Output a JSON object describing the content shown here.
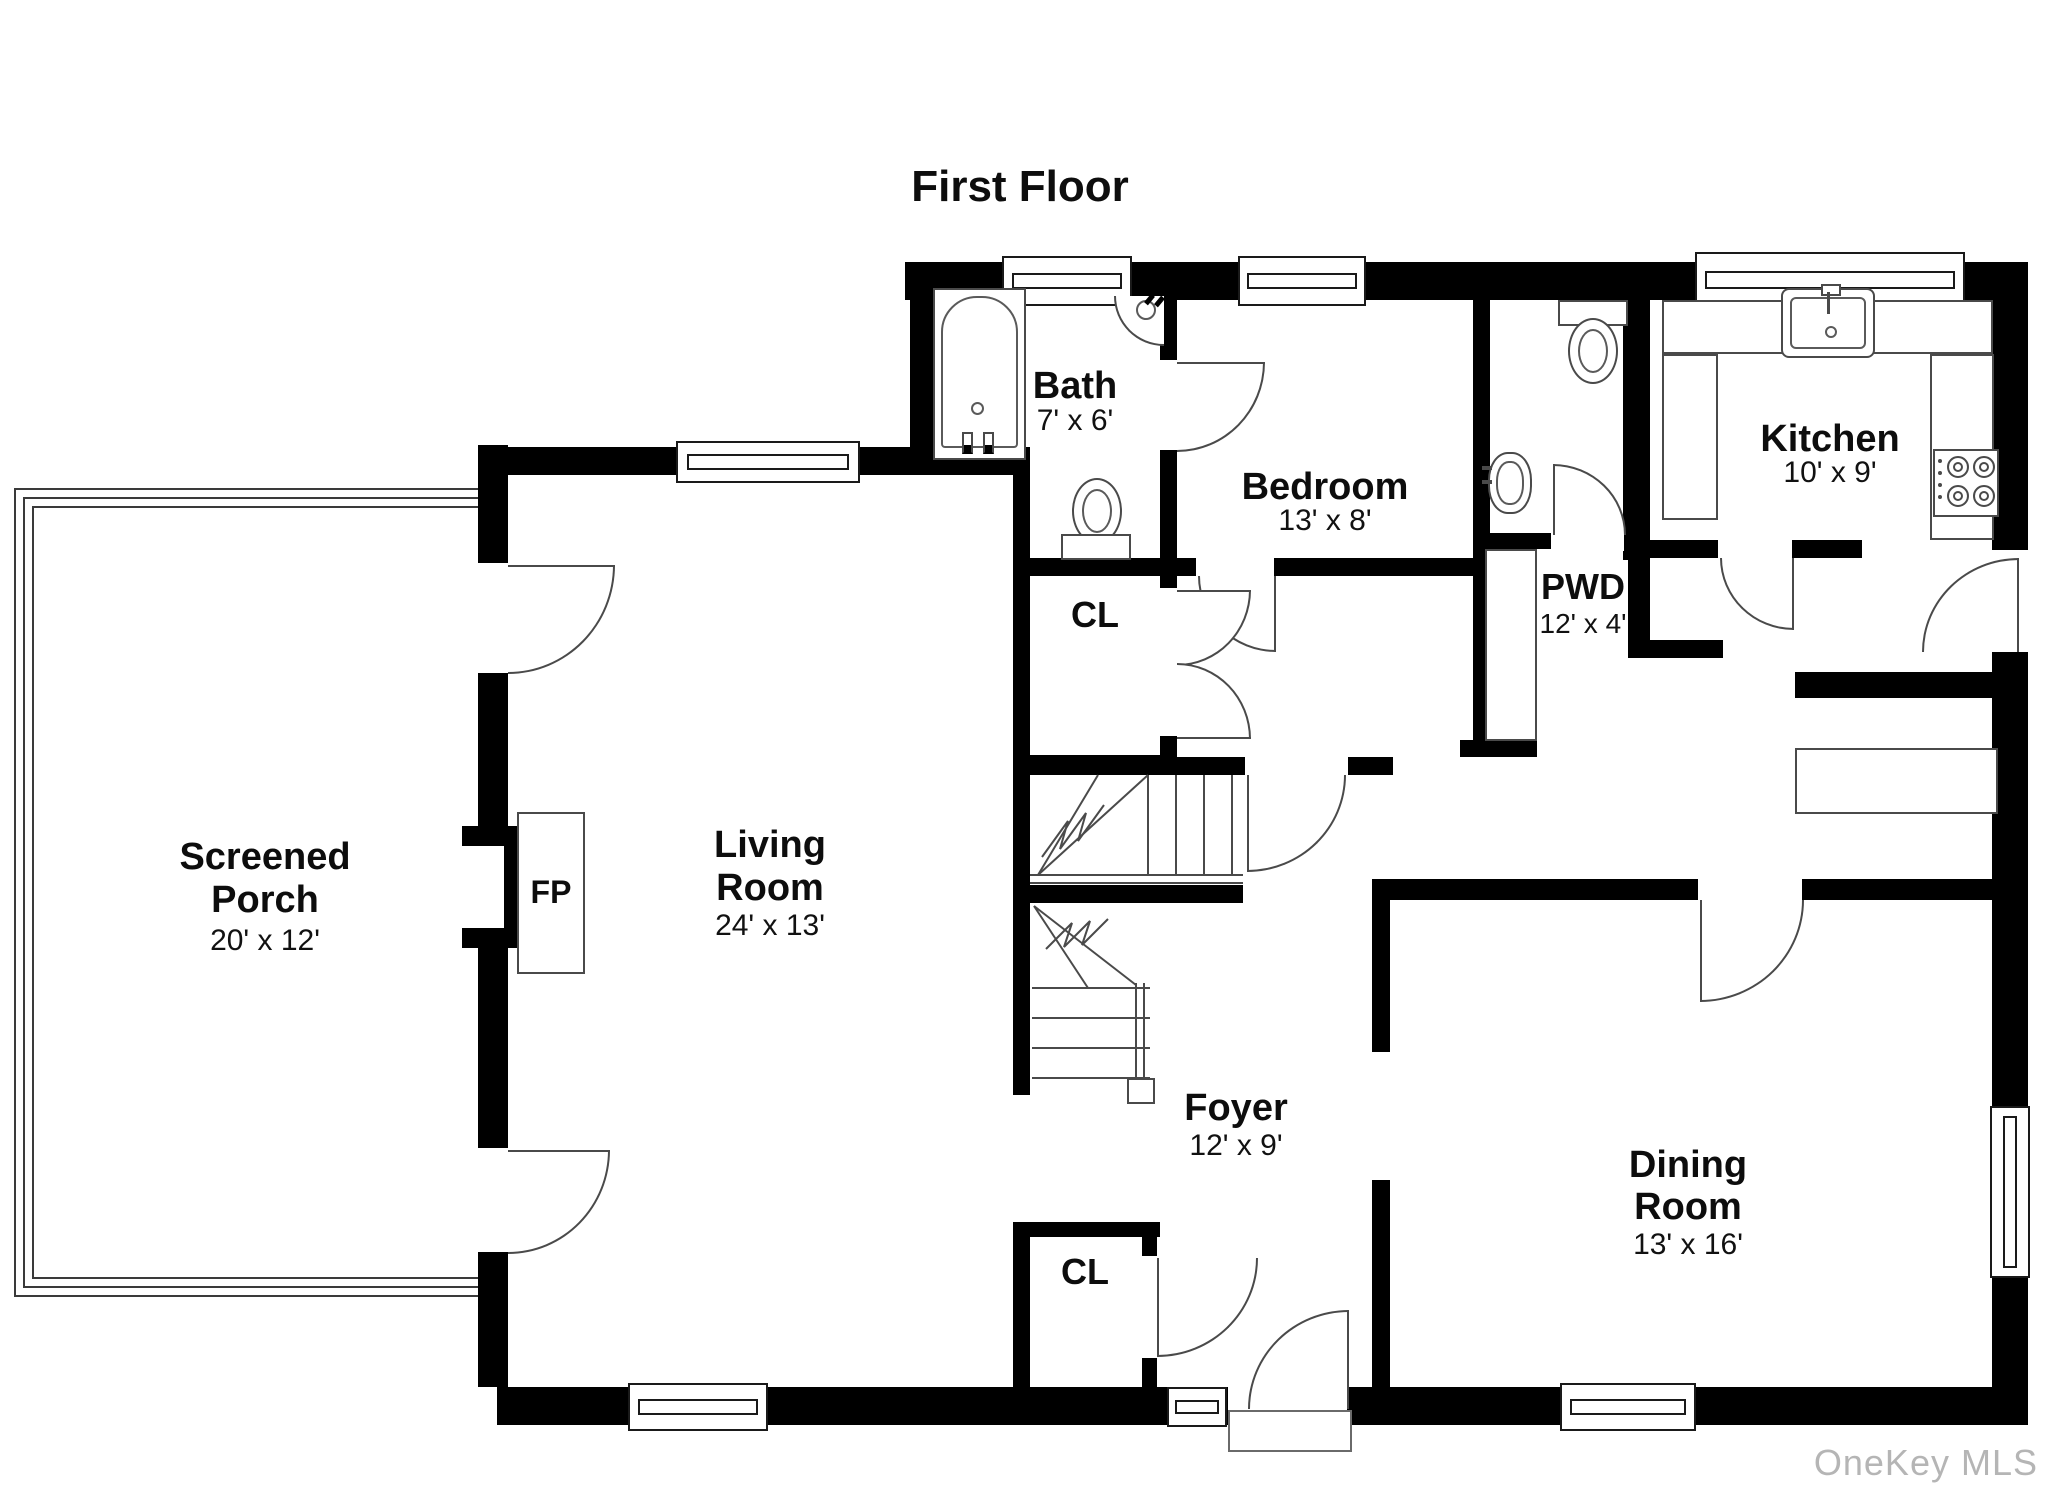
{
  "title": "First Floor",
  "watermark": "OneKey MLS",
  "rooms": {
    "screened_porch": {
      "line1": "Screened",
      "line2": "Porch",
      "dims": "20' x 12'"
    },
    "living_room": {
      "line1": "Living",
      "line2": "Room",
      "dims": "24' x 13'"
    },
    "bath": {
      "name": "Bath",
      "dims": "7' x 6'"
    },
    "bedroom": {
      "name": "Bedroom",
      "dims": "13' x 8'"
    },
    "pwd": {
      "name": "PWD",
      "dims": "12' x 4'"
    },
    "kitchen": {
      "name": "Kitchen",
      "dims": "10' x 9'"
    },
    "foyer": {
      "name": "Foyer",
      "dims": "12' x 9'"
    },
    "dining_room": {
      "line1": "Dining",
      "line2": "Room",
      "dims": "13' x 16'"
    }
  },
  "annotations": {
    "fireplace": "FP",
    "closet_upper": "CL",
    "closet_lower": "CL"
  },
  "colors": {
    "wall": "#000000",
    "fixture_line": "#4a4a4a",
    "watermark": "#b5b5b5",
    "background": "#ffffff"
  }
}
